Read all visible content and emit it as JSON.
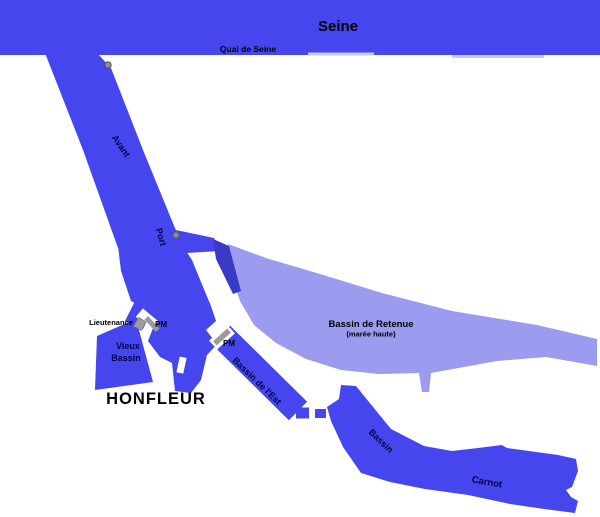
{
  "map": {
    "labels": {
      "seine": "Seine",
      "quai": "Quai de Seine",
      "avant": "Avant",
      "port": "Port",
      "lieutenance": "Lieutenance",
      "pm_vieux": "PM",
      "pm_est": "PM",
      "vieux_line1": "Vieux",
      "vieux_line2": "Bassin",
      "honfleur": "HONFLEUR",
      "retenue": "Bassin de Retenue",
      "retenue_sub": "(marée haute)",
      "est": "Bassin de l'Est",
      "carnot_line1": "Bassin",
      "carnot_line2": "Carnot"
    },
    "colors": {
      "water": "#4646ee",
      "retenue_water": "#9b9bf0",
      "dark_water": "#3a3ac6",
      "structure": "#9b9b9b",
      "structure_edge": "#777777",
      "marker": "#8d8d8d",
      "marker_outline": "#4f4f4f",
      "quay_edge": "#c6cbf6",
      "gap": "#ffffff",
      "label_dark": "#000000",
      "label_water": "#000044"
    }
  }
}
